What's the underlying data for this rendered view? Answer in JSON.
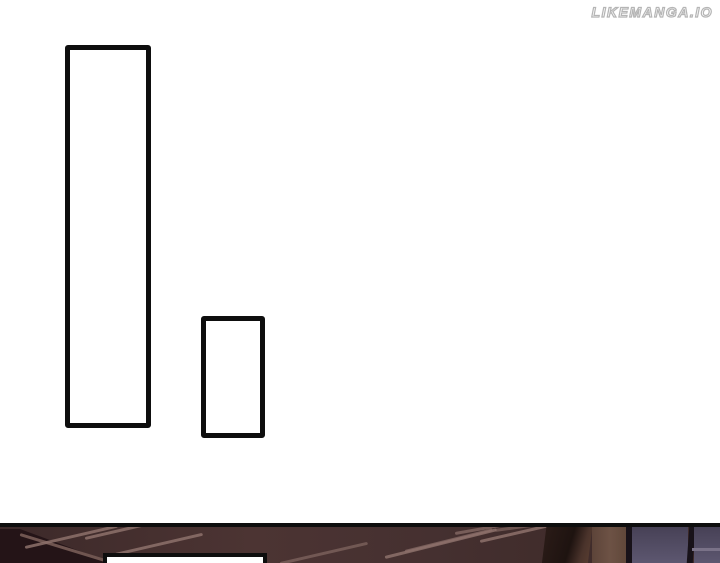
{
  "page": {
    "kind": "manga-page",
    "background": "#ffffff"
  },
  "watermark": {
    "text": "LIKEMANGA.IO"
  },
  "bubbles": {
    "tall": {
      "text": ""
    },
    "small": {
      "text": ""
    },
    "bottom": {
      "text": ""
    }
  },
  "colors": {
    "ink": "#0e0e0e",
    "page_bg": "#ffffff",
    "watermark_outline": "#b5b5b5",
    "watermark_fill": "#ffffff",
    "ceiling_a": "#3c2929",
    "ceiling_b": "#4c3433",
    "ceiling_c": "#453030",
    "corner_dark": "#241417",
    "wedge_highlight": "#6f5550",
    "streak": "#8d716b",
    "beam_dark": "#1e1310",
    "beam_edge": "#573c30",
    "wood_strip": "#6d5245",
    "frame_dark": "#181219",
    "pane_top": "#474156",
    "pane_bottom": "#5d5770",
    "pane_line": "#7a7288",
    "bubble_fill": "#ffffff"
  }
}
